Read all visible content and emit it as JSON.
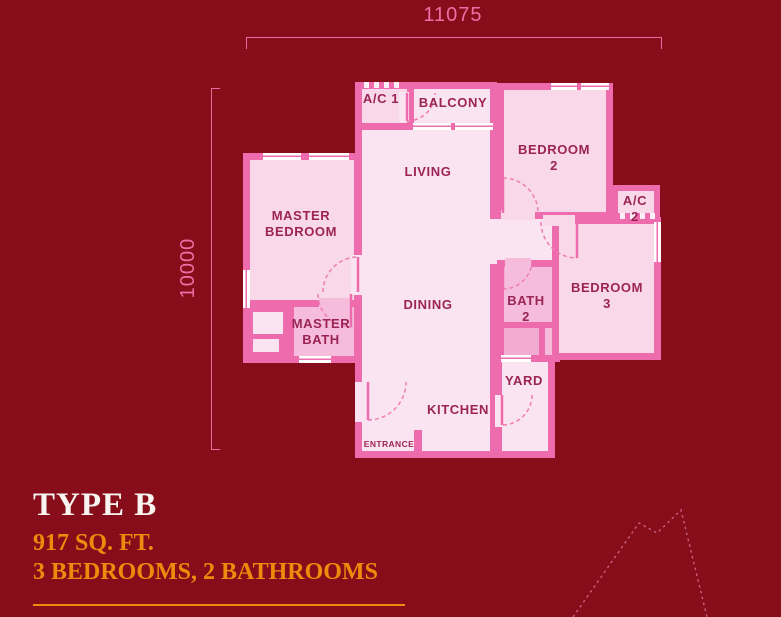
{
  "colors": {
    "background": "#870D1B",
    "wall": "#EE6CAD",
    "room_light": "#FBE4F1",
    "room_mid": "#F8D8E9",
    "room_bath": "#F5BDDB",
    "room_bath_dark": "#F2ACD1",
    "room_label": "#9C2356",
    "door_arc": "#F07CB4",
    "dimension_pink": "#ED6FA5",
    "accent_orange": "#EF8A0C",
    "title_white": "#F8F4EF",
    "decor_line": "#C96080"
  },
  "dimensions": {
    "width_label": "11075",
    "height_label": "10000"
  },
  "plan": {
    "labels": {
      "ac1": "A/C 1",
      "balcony": "BALCONY",
      "living": "LIVING",
      "master_bedroom": "MASTER\nBEDROOM",
      "bedroom2": "BEDROOM\n2",
      "ac2": "A/C 2",
      "bedroom3": "BEDROOM\n3",
      "bath2": "BATH\n2",
      "master_bath": "MASTER\nBATH",
      "dining": "DINING",
      "yard": "YARD",
      "kitchen": "KITCHEN",
      "entrance": "ENTRANCE"
    }
  },
  "unit_info": {
    "type_name": "TYPE B",
    "area": "917 SQ. FT.",
    "rooms": "3 BEDROOMS, 2 BATHROOMS"
  }
}
